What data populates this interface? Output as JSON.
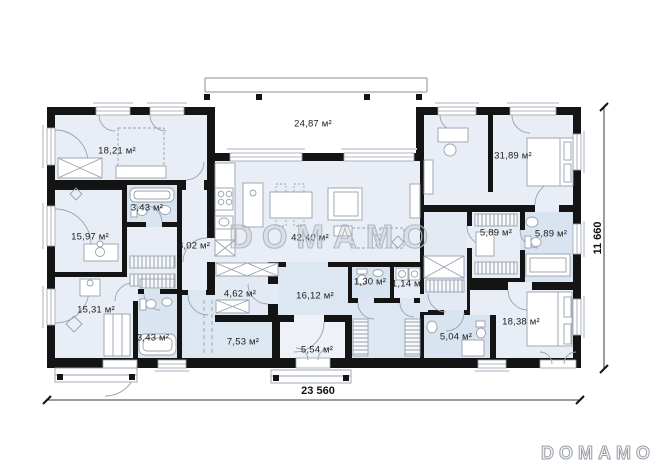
{
  "rooms": [
    {
      "name": "bedroom-top-left",
      "area": "18,21 м²"
    },
    {
      "name": "terrace",
      "area": "24,87 м²"
    },
    {
      "name": "bedroom-top-right",
      "area": "31,89 м²"
    },
    {
      "name": "room-left-middle",
      "area": "15,97 м²"
    },
    {
      "name": "bathroom-left-upper",
      "area": "3,43 м²"
    },
    {
      "name": "corridor-left",
      "area": "8,02 м²"
    },
    {
      "name": "living-room",
      "area": "42,40 м²"
    },
    {
      "name": "wardrobe-right",
      "area": "5,89 м²"
    },
    {
      "name": "bathroom-right",
      "area": "5,89 м²"
    },
    {
      "name": "room-bottom-left",
      "area": "15,31 м²"
    },
    {
      "name": "bathroom-left-lower",
      "area": "3,43 м²"
    },
    {
      "name": "hallway-462",
      "area": "4,62 м²"
    },
    {
      "name": "hall-center",
      "area": "16,12 м²"
    },
    {
      "name": "wc-small",
      "area": "1,30 м²"
    },
    {
      "name": "storage-small",
      "area": "1,14 м²"
    },
    {
      "name": "room-753",
      "area": "7,53 м²"
    },
    {
      "name": "vestibule",
      "area": "5,54 м²"
    },
    {
      "name": "bathroom-bottom",
      "area": "5,04 м²"
    },
    {
      "name": "bedroom-bottom-right",
      "area": "18,38 м²"
    }
  ],
  "dimensions": {
    "width_total": "23 560",
    "height_total": "11 660"
  },
  "watermark": "DOMAMO",
  "logo": "DOMAMO",
  "colors": {
    "wall": "#141414",
    "floor": "#e9eef6",
    "bath": "#d9e4f1",
    "hall": "#dde7f2",
    "accent_line": "#98a1ac"
  }
}
